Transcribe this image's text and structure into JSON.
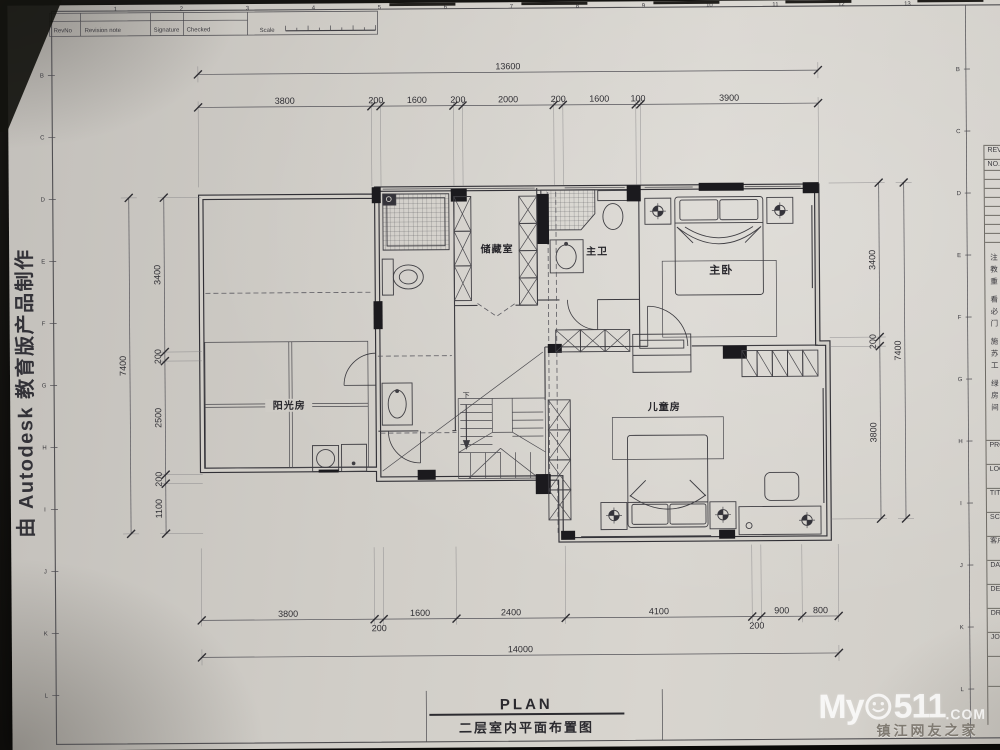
{
  "sheet": {
    "revision_table": {
      "rev_no": "RevNo",
      "revision_note": "Revision note",
      "signature": "Signature",
      "checked": "Checked",
      "scale_label": "Scale"
    },
    "edge_note": "由 Autodesk 教育版产品制作",
    "ruler_letters": [
      "B",
      "C",
      "D",
      "E",
      "F",
      "G",
      "H",
      "I",
      "J",
      "K",
      "L"
    ],
    "ruler_numbers": [
      "1",
      "2",
      "3",
      "4",
      "5",
      "6",
      "7",
      "8",
      "9",
      "10",
      "11",
      "12",
      "13"
    ]
  },
  "title_block": {
    "rev_label": "REV",
    "no_label": "NO.",
    "notes": [
      "注",
      "教",
      "重",
      "看",
      "必",
      "门",
      "施",
      "苏",
      "工",
      "绿",
      "房",
      "间"
    ],
    "field_labels": [
      "PRO",
      "LOC",
      "TIT",
      "SCA",
      "客户",
      "DAT",
      "DES",
      "DR",
      "JO"
    ]
  },
  "plan": {
    "title_en": "PLAN",
    "title_cn": "二层室内平面布置图",
    "rooms": [
      {
        "name": "储藏室"
      },
      {
        "name": "主卫"
      },
      {
        "name": "主卧"
      },
      {
        "name": "阳光房"
      },
      {
        "name": "儿童房"
      }
    ],
    "stair_down_label": "下",
    "dimensions": {
      "top_total": 13600,
      "top_segments": [
        3800,
        200,
        1600,
        200,
        2000,
        200,
        1600,
        100,
        3900
      ],
      "left_total": 7400,
      "left_segments": [
        3400,
        200,
        2500,
        200,
        1100
      ],
      "right_total": 7400,
      "right_segments": [
        3400,
        200,
        3800
      ],
      "bottom_total": 14000,
      "bottom_segments": [
        3800,
        200,
        1600,
        2400,
        4100,
        200,
        900,
        800
      ]
    }
  },
  "watermark": {
    "prefix": "My",
    "number": "511",
    "suffix": ".COM",
    "subtitle": "镇江网友之家"
  }
}
